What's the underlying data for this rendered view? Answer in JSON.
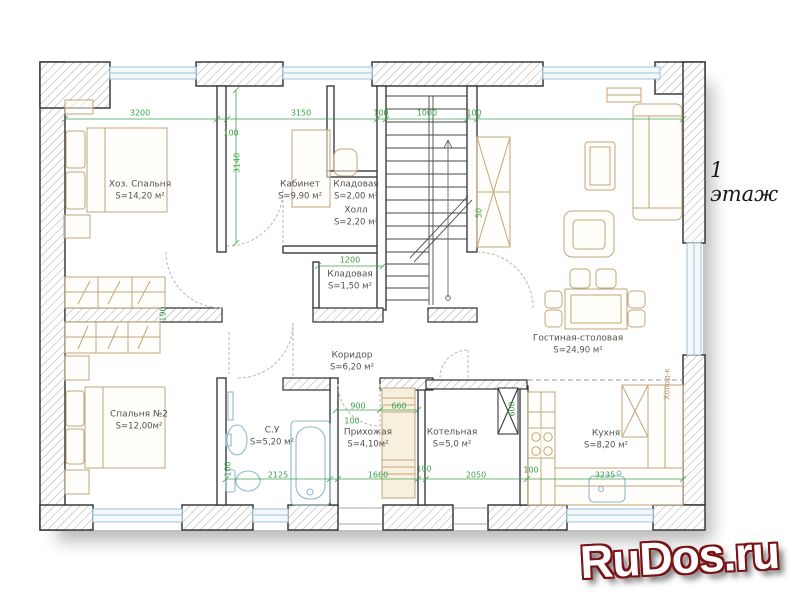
{
  "title": "1 этаж",
  "watermark": "RuDos.ru",
  "rooms": [
    {
      "name": "Хоз. Спальня",
      "area": "S=14,20 м²"
    },
    {
      "name": "Кабинет",
      "area": "S=9,90 м²"
    },
    {
      "name": "Кладовая",
      "area": "S=2,00 м²"
    },
    {
      "name": "Холл",
      "area": "S=2,20 м²"
    },
    {
      "name": "Кладовая",
      "area": "S=1,50 м²"
    },
    {
      "name": "Гостиная-столовая",
      "area": "S=24,90 м²"
    },
    {
      "name": "Спальня №2",
      "area": "S=12,00м²"
    },
    {
      "name": "Коридор",
      "area": "S=6,20 м²"
    },
    {
      "name": "С.У",
      "area": "S=5,20 м²"
    },
    {
      "name": "Прихожая",
      "area": "S=4,10м²"
    },
    {
      "name": "Котельная",
      "area": "S=5,0 м²"
    },
    {
      "name": "Кухня",
      "area": "S=8,20 м²"
    }
  ],
  "appliances": {
    "fridge": "Холод-к"
  },
  "dimensions": {
    "top": [
      "3200",
      "100",
      "3150",
      "100",
      "1000",
      "100"
    ],
    "cabinet_depth": "3140",
    "stair_gap": "50",
    "pantry_width": "1200",
    "corridor": [
      "900",
      "660",
      "100"
    ],
    "bottom": [
      "2125",
      "1660",
      "100",
      "2050",
      "3235"
    ],
    "boiler": [
      "600",
      "100"
    ],
    "bathroom": "100",
    "bedroom_wall": "190"
  },
  "colors": {
    "dimension_green": "#3aa048",
    "furniture_tan": "#c2a678",
    "fixture_blue": "#90b8ca",
    "window_blue": "#9cc3d6",
    "wall_outline": "#2d2d2d",
    "watermark_outline": "#7a1216"
  }
}
